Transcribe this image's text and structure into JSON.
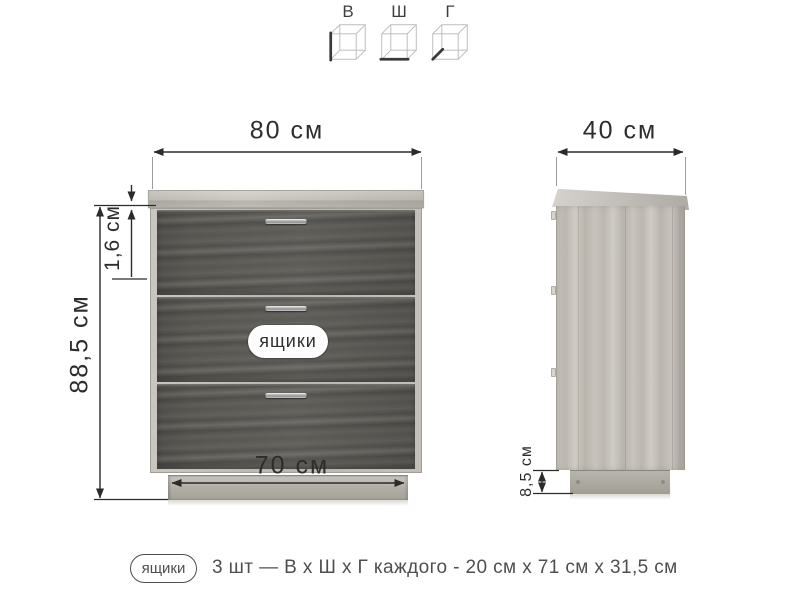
{
  "legend": {
    "items": [
      {
        "id": "height",
        "label": "В"
      },
      {
        "id": "width",
        "label": "Ш"
      },
      {
        "id": "depth",
        "label": "Г"
      }
    ]
  },
  "front_view": {
    "width_label": "80 см",
    "height_label": "88,5 см",
    "top_thickness_label": "1,6 см",
    "plinth_width_label": "70 см",
    "drawers_badge": "ящики",
    "drawer_count": 3
  },
  "side_view": {
    "depth_label": "40 см",
    "plinth_height_label": "8,5 см"
  },
  "caption": {
    "badge": "ящики",
    "text": "3 шт — В х Ш х Г каждого - 20 см х 71 см х 31,5 см"
  },
  "colors": {
    "background": "#ffffff",
    "dimension_line": "#2b2b2b",
    "extension_line": "#9b9b9b",
    "oak_light": "#c6c3bc",
    "drawer_dark": "#595752",
    "text": "#2f2f2f"
  }
}
